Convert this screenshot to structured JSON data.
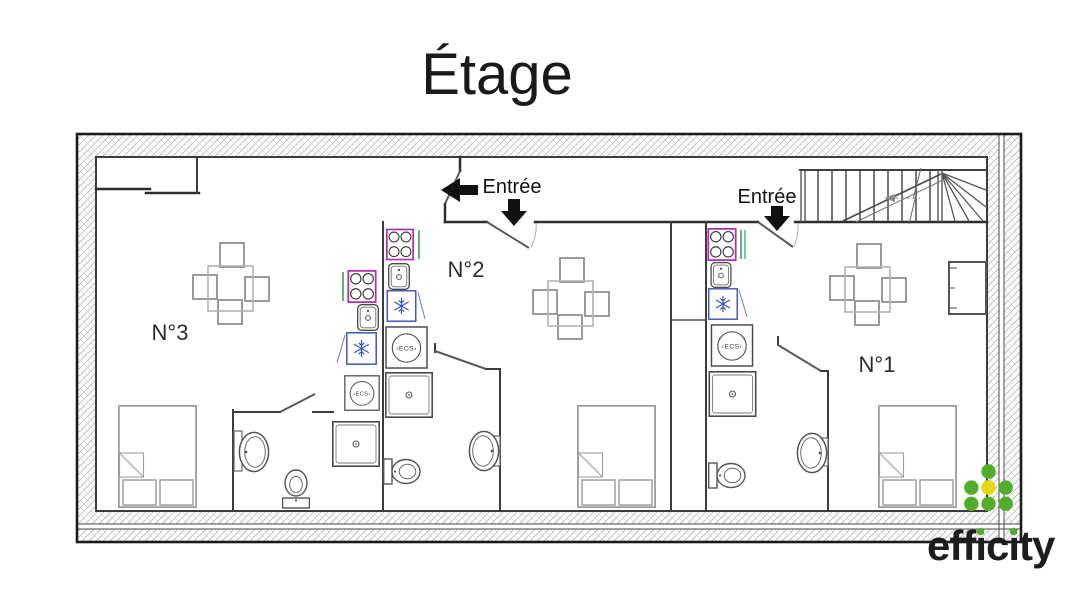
{
  "page": {
    "title": "Étage",
    "background": "#ffffff"
  },
  "plan": {
    "units": [
      {
        "label": "N°1"
      },
      {
        "label": "N°2"
      },
      {
        "label": "N°3"
      }
    ],
    "entrances": [
      {
        "label": "Entrée",
        "arrow": "down"
      },
      {
        "label": "Entrée",
        "arrow": "down"
      }
    ],
    "entry_side_arrow": "left",
    "fixtures": {
      "water_heater_label": "‹ECS›",
      "kitchen_items": [
        "stove",
        "sink",
        "fridge",
        "water-heater",
        "shower"
      ],
      "bathroom_items": [
        "shower",
        "toilet",
        "washbasin"
      ],
      "bedroom_items": [
        "double-bed"
      ],
      "living_items": [
        "table-with-4-chairs"
      ]
    },
    "colors": {
      "wall": "#3c3c3c",
      "hatch": "#b6b6b6",
      "stove_accent": "#b32bb0",
      "fridge_accent": "#3d57b8",
      "snowflake_blue": "#2f55cc",
      "counter_green": "#3f9f4e",
      "counter_teal": "#3aacac",
      "furniture_gray": "#9e9e9e"
    }
  },
  "logo": {
    "text": "efficity",
    "green": "#52ad2c",
    "yellow": "#e5d60f",
    "text_color": "#1d1d1d"
  }
}
